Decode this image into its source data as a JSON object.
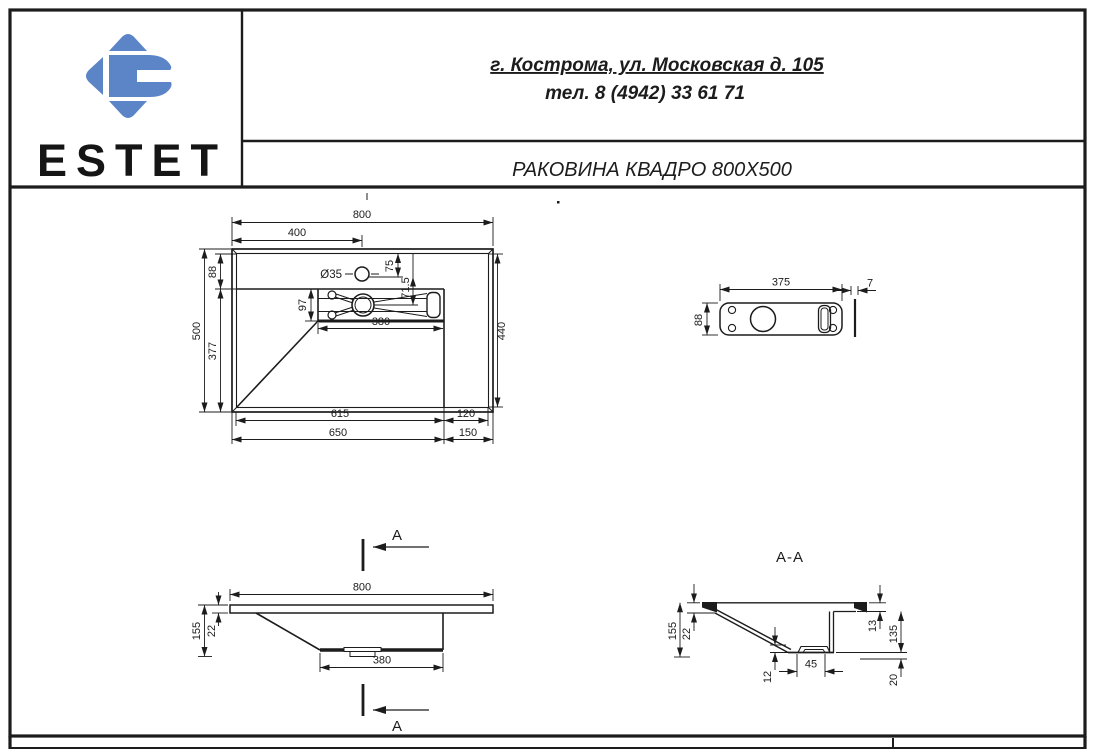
{
  "header": {
    "brand": "ESTET",
    "address": "г. Кострома, ул. Московская д. 105",
    "phone": "тел. 8 (4942) 33 61 71",
    "title": "РАКОВИНА КВАДРО 800X500"
  },
  "colors": {
    "logo_blue": "#5b85c6",
    "line": "#1c1c1c"
  },
  "drawing": {
    "top_view": {
      "dims": {
        "overall_width": "800",
        "faucet_offset": "400",
        "faucet_hole": "Ø35",
        "hole_from_back": "75",
        "hole_to_drain": "71.5",
        "deck_depth": "88",
        "overall_depth": "500",
        "bowl_depth": "377",
        "recess_depth": "97",
        "recess_width": "380",
        "right_inner_depth": "440",
        "bowl_inner_width": "615",
        "right_deck_inner": "120",
        "bowl_outer_width": "650",
        "right_deck_outer": "150"
      }
    },
    "plate_view": {
      "dims": {
        "width": "375",
        "height": "88",
        "thickness": "7"
      }
    },
    "front_view": {
      "section_letter": "A",
      "dims": {
        "overall_width": "800",
        "total_height": "155",
        "slab_thickness": "22",
        "bottom_width": "380"
      }
    },
    "section_view": {
      "title": "A-A",
      "dims": {
        "total_height": "155",
        "slab_thickness": "22",
        "deck_thickness": "13",
        "inner_height": "135",
        "recess_step": "12",
        "recess_width": "45",
        "outlet_height": "20"
      }
    }
  }
}
